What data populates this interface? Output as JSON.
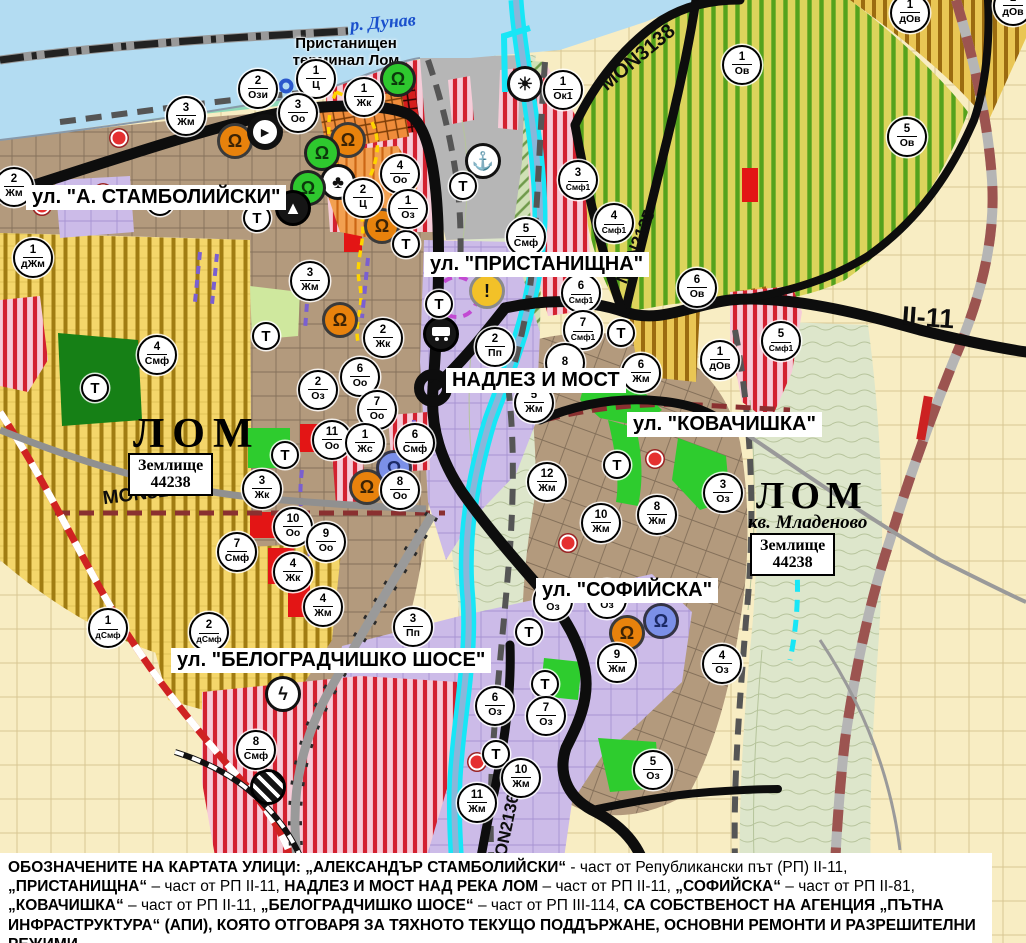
{
  "palette": {
    "accent_red": "#d32130",
    "water": "#b3dcf2",
    "channel_cyan": "#18e6f6",
    "urban_brown": "#b39a7d",
    "lavender": "#ccbbe8",
    "vineyard_yellow": "#f4d66a",
    "orchard_green": "#54a21d",
    "industrial_pink": "#f6ccd8",
    "park_green": "#2ecc2e",
    "boundary_red": "#cf2222"
  },
  "labels": {
    "river": "р. Дунав",
    "port_line1": "Пристанищен",
    "port_line2": "терминал Лом",
    "lom_left": "ЛОМ",
    "lom_right": "ЛОМ",
    "kvartal": "кв. Младеново",
    "land_box": {
      "line1": "Землище",
      "line2": "44238"
    },
    "streets": [
      {
        "text": "ул. \"А. СТАМБОЛИЙСКИ\"",
        "x": 26,
        "y": 185
      },
      {
        "text": "ул. \"ПРИСТАНИЩНА\"",
        "x": 424,
        "y": 252
      },
      {
        "text": "НАДЛЕЗ И МОСТ",
        "x": 446,
        "y": 368
      },
      {
        "text": "ул. \"КОВАЧИШКА\"",
        "x": 627,
        "y": 412
      },
      {
        "text": "ул. \"СОФИЙСКА\"",
        "x": 536,
        "y": 578
      },
      {
        "text": "ул. \"БЕЛОГРАДЧИШКО ШОСЕ\"",
        "x": 171,
        "y": 648
      }
    ],
    "roads": [
      {
        "text": "MON3139",
        "x": 146,
        "y": 494,
        "rot": -7,
        "size": 19
      },
      {
        "text": "MON3138",
        "x": 638,
        "y": 58,
        "rot": -40,
        "size": 20
      },
      {
        "text": "MON2135",
        "x": 636,
        "y": 247,
        "rot": -68,
        "size": 17
      },
      {
        "text": "MON2136",
        "x": 506,
        "y": 832,
        "rot": -78,
        "size": 17
      },
      {
        "text": "II-11",
        "x": 928,
        "y": 318,
        "rot": 4,
        "size": 27
      }
    ]
  },
  "t_label": "Т",
  "markers": [
    {
      "n": "2",
      "z": "Жм",
      "x": 14,
      "y": 187
    },
    {
      "n": "3",
      "z": "Жм",
      "x": 186,
      "y": 116
    },
    {
      "n": "2",
      "z": "Ози",
      "x": 258,
      "y": 89
    },
    {
      "n": "1",
      "z": "Ц",
      "x": 316,
      "y": 79
    },
    {
      "n": "1",
      "z": "Жк",
      "x": 364,
      "y": 97
    },
    {
      "n": "3",
      "z": "Оо",
      "x": 298,
      "y": 113
    },
    {
      "n": "4",
      "z": "Оо",
      "x": 400,
      "y": 174
    },
    {
      "n": "2",
      "z": "Ц",
      "x": 363,
      "y": 198
    },
    {
      "n": "1",
      "z": "Оз",
      "x": 408,
      "y": 209
    },
    {
      "n": "1",
      "z": "дЖм",
      "x": 33,
      "y": 258
    },
    {
      "n": "4",
      "z": "Смф",
      "x": 157,
      "y": 355
    },
    {
      "n": "3",
      "z": "Жм",
      "x": 310,
      "y": 281
    },
    {
      "n": "2",
      "z": "Жк",
      "x": 383,
      "y": 338
    },
    {
      "n": "2",
      "z": "Оз",
      "x": 318,
      "y": 390
    },
    {
      "n": "6",
      "z": "Оо",
      "x": 360,
      "y": 377
    },
    {
      "n": "7",
      "z": "Оо",
      "x": 377,
      "y": 410
    },
    {
      "n": "11",
      "z": "Оо",
      "x": 332,
      "y": 440
    },
    {
      "n": "1",
      "z": "Жс",
      "x": 365,
      "y": 443
    },
    {
      "n": "6",
      "z": "Смф",
      "x": 415,
      "y": 443
    },
    {
      "n": "8",
      "z": "Оо",
      "x": 400,
      "y": 490
    },
    {
      "n": "3",
      "z": "Жк",
      "x": 262,
      "y": 489
    },
    {
      "n": "10",
      "z": "Оо",
      "x": 293,
      "y": 527
    },
    {
      "n": "9",
      "z": "Оо",
      "x": 326,
      "y": 542
    },
    {
      "n": "4",
      "z": "Жк",
      "x": 293,
      "y": 572
    },
    {
      "n": "4",
      "z": "Жм",
      "x": 323,
      "y": 607
    },
    {
      "n": "7",
      "z": "Смф",
      "x": 237,
      "y": 552
    },
    {
      "n": "2",
      "z": "дСмф",
      "x": 209,
      "y": 632
    },
    {
      "n": "1",
      "z": "дСмф",
      "x": 108,
      "y": 628
    },
    {
      "n": "8",
      "z": "Смф",
      "x": 256,
      "y": 750
    },
    {
      "n": "3",
      "z": "Пп",
      "x": 413,
      "y": 627
    },
    {
      "n": "2",
      "z": "Пп",
      "x": 495,
      "y": 347
    },
    {
      "n": "5",
      "z": "Смф",
      "x": 526,
      "y": 237
    },
    {
      "n": "3",
      "z": "Смф1",
      "x": 578,
      "y": 180
    },
    {
      "n": "4",
      "z": "Смф1",
      "x": 614,
      "y": 223
    },
    {
      "n": "6",
      "z": "Смф1",
      "x": 581,
      "y": 293
    },
    {
      "n": "7",
      "z": "Смф1",
      "x": 583,
      "y": 330
    },
    {
      "n": "8",
      "z": "",
      "x": 565,
      "y": 363
    },
    {
      "n": "5",
      "z": "Жм",
      "x": 534,
      "y": 403
    },
    {
      "n": "12",
      "z": "Жм",
      "x": 547,
      "y": 482
    },
    {
      "n": "6",
      "z": "Жм",
      "x": 641,
      "y": 373
    },
    {
      "n": "10",
      "z": "Жм",
      "x": 601,
      "y": 523
    },
    {
      "n": "8",
      "z": "Жм",
      "x": 657,
      "y": 515
    },
    {
      "n": "3",
      "z": "Оз",
      "x": 723,
      "y": 493
    },
    {
      "n": "1",
      "z": "Ок1",
      "x": 563,
      "y": 90
    },
    {
      "n": "1",
      "z": "Ов",
      "x": 742,
      "y": 65
    },
    {
      "n": "5",
      "z": "Ов",
      "x": 907,
      "y": 137
    },
    {
      "n": "1",
      "z": "дОв",
      "x": 910,
      "y": 13
    },
    {
      "n": "1",
      "z": "дОв",
      "x": 1013,
      "y": 6
    },
    {
      "n": "6",
      "z": "Ов",
      "x": 697,
      "y": 288
    },
    {
      "n": "5",
      "z": "Смф1",
      "x": 781,
      "y": 341
    },
    {
      "n": "1",
      "z": "дОв",
      "x": 720,
      "y": 360
    },
    {
      "n": "9",
      "z": "Жм",
      "x": 617,
      "y": 663
    },
    {
      "n": "4",
      "z": "Оз",
      "x": 722,
      "y": 664
    },
    {
      "n": "6",
      "z": "Оз",
      "x": 495,
      "y": 706
    },
    {
      "n": "7",
      "z": "Оз",
      "x": 546,
      "y": 716
    },
    {
      "n": "10",
      "z": "Жм",
      "x": 521,
      "y": 778
    },
    {
      "n": "11",
      "z": "Жм",
      "x": 477,
      "y": 803
    },
    {
      "n": "5",
      "z": "Оз",
      "x": 653,
      "y": 770
    },
    {
      "n": "",
      "z": "Оз",
      "x": 553,
      "y": 601
    },
    {
      "n": "",
      "z": "Оз",
      "x": 607,
      "y": 599
    }
  ],
  "t_markers": [
    {
      "x": 160,
      "y": 202
    },
    {
      "x": 257,
      "y": 218
    },
    {
      "x": 406,
      "y": 244
    },
    {
      "x": 95,
      "y": 388
    },
    {
      "x": 266,
      "y": 336
    },
    {
      "x": 285,
      "y": 455
    },
    {
      "x": 463,
      "y": 186
    },
    {
      "x": 439,
      "y": 304
    },
    {
      "x": 621,
      "y": 333
    },
    {
      "x": 617,
      "y": 465
    },
    {
      "x": 529,
      "y": 632
    },
    {
      "x": 545,
      "y": 684
    },
    {
      "x": 496,
      "y": 754
    }
  ],
  "icons": [
    {
      "glyph": "monument",
      "color": "orange",
      "x": 235,
      "y": 141
    },
    {
      "glyph": "one-way",
      "color": "white",
      "x": 265,
      "y": 132
    },
    {
      "glyph": "monument",
      "color": "orange",
      "x": 348,
      "y": 140
    },
    {
      "glyph": "monument",
      "color": "green",
      "x": 398,
      "y": 79
    },
    {
      "glyph": "monument",
      "color": "green",
      "x": 322,
      "y": 153
    },
    {
      "glyph": "clover",
      "color": "white",
      "x": 338,
      "y": 182
    },
    {
      "glyph": "monument",
      "color": "green",
      "x": 308,
      "y": 188
    },
    {
      "glyph": "peak",
      "color": "black",
      "x": 293,
      "y": 208
    },
    {
      "glyph": "monument",
      "color": "orange",
      "x": 382,
      "y": 226
    },
    {
      "glyph": "monument",
      "color": "orange",
      "x": 340,
      "y": 320
    },
    {
      "glyph": "monument",
      "color": "orange",
      "x": 367,
      "y": 487
    },
    {
      "glyph": "monument",
      "color": "blue",
      "x": 394,
      "y": 468
    },
    {
      "glyph": "sun",
      "color": "white",
      "x": 525,
      "y": 84
    },
    {
      "glyph": "anchor",
      "color": "white",
      "x": 483,
      "y": 161
    },
    {
      "glyph": "truck",
      "color": "black",
      "x": 441,
      "y": 334
    },
    {
      "glyph": "warning",
      "color": "yellow",
      "x": 487,
      "y": 291
    },
    {
      "glyph": "monument",
      "color": "orange",
      "x": 627,
      "y": 633
    },
    {
      "glyph": "monument",
      "color": "blue",
      "x": 661,
      "y": 621
    },
    {
      "glyph": "lightning",
      "color": "white",
      "x": 283,
      "y": 694
    },
    {
      "glyph": "rail-crossing",
      "color": "black",
      "x": 268,
      "y": 787
    }
  ],
  "dots": [
    {
      "x": 119,
      "y": 138
    },
    {
      "x": 103,
      "y": 193
    },
    {
      "x": 42,
      "y": 206
    },
    {
      "x": 568,
      "y": 543
    },
    {
      "x": 655,
      "y": 459
    },
    {
      "x": 477,
      "y": 762
    }
  ],
  "rings": [
    {
      "x": 286,
      "y": 86
    }
  ],
  "caption": {
    "runs": [
      {
        "t": "ОБОЗНАЧЕНИТЕ НА КАРТАТА УЛИЦИ: „АЛЕКСАНДЪР СТАМБОЛИЙСКИ“",
        "b": true
      },
      {
        "t": " - част от Републикански път (РП) II-11, ",
        "b": false
      },
      {
        "t": "„ПРИСТАНИЩНА“",
        "b": true
      },
      {
        "t": " – част от РП II-11, ",
        "b": false
      },
      {
        "t": "НАДЛЕЗ И МОСТ НАД РЕКА ЛОМ",
        "b": true
      },
      {
        "t": " – част от РП II-11, ",
        "b": false
      },
      {
        "t": "„СОФИЙСКА“",
        "b": true
      },
      {
        "t": " – част от РП II-81, ",
        "b": false
      },
      {
        "t": "„КОВАЧИШКА“",
        "b": true
      },
      {
        "t": " – част от РП II-11, ",
        "b": false
      },
      {
        "t": "„БЕЛОГРАДЧИШКО ШОСЕ“",
        "b": true
      },
      {
        "t": " – част от РП III-114, ",
        "b": false
      },
      {
        "t": "СА СОБСТВЕНОСТ НА АГЕНЦИЯ „ПЪТНА ИНФРАСТРУКТУРА“ (АПИ), КОЯТО ОТГОВАРЯ ЗА ТЯХНОТО ТЕКУЩО ПОДДЪРЖАНЕ, ОСНОВНИ РЕМОНТИ И РАЗРЕШИТЕЛНИ РЕЖИМИ.",
        "b": true
      }
    ]
  }
}
